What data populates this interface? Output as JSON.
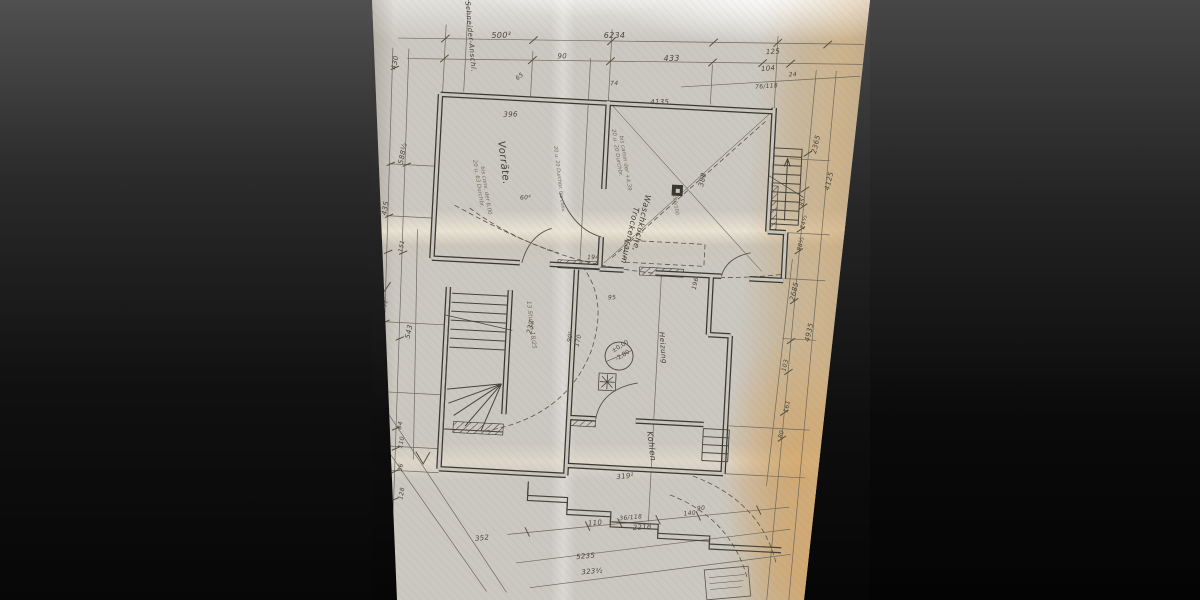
{
  "colors": {
    "paper": "#cbc8c1",
    "ink": "#4a463c",
    "walls": "#3a372f",
    "pencil": "#746e5e",
    "stain_tan": "#c89a5e",
    "stain_orange": "#e4983e",
    "letterbox": "#141414"
  },
  "plan": {
    "drawing_type": "cellar floor plan (aged blueprint photograph)",
    "labels": [
      {
        "id": "dim-500",
        "t": "500³",
        "x": 108,
        "y": 45,
        "r": -4,
        "s": 8
      },
      {
        "id": "dim-6234",
        "t": "6234",
        "x": 220,
        "y": 39,
        "r": -3,
        "s": 8
      },
      {
        "id": "dim-90",
        "t": "90",
        "x": 175,
        "y": 62,
        "r": -4,
        "s": 7
      },
      {
        "id": "dim-433",
        "t": "433",
        "x": 281,
        "y": 59,
        "r": -4,
        "s": 8
      },
      {
        "id": "dim-65",
        "t": "65",
        "x": 136,
        "y": 86,
        "r": -40,
        "s": 6
      },
      {
        "id": "dim-74",
        "t": "74",
        "x": 229,
        "y": 86,
        "r": -4,
        "s": 6
      },
      {
        "id": "dim-125",
        "t": "125",
        "x": 383,
        "y": 47,
        "r": -7,
        "s": 7
      },
      {
        "id": "dim-104",
        "t": "104",
        "x": 379,
        "y": 64,
        "r": -7,
        "s": 7
      },
      {
        "id": "dim-24",
        "t": "24",
        "x": 407,
        "y": 68,
        "r": -7,
        "s": 6
      },
      {
        "id": "dim-76-118",
        "t": "76/118",
        "x": 374,
        "y": 82,
        "r": -7,
        "s": 6
      },
      {
        "id": "dim-430",
        "t": "430",
        "x": 14,
        "y": 82,
        "r": -82,
        "s": 7
      },
      {
        "id": "dim-588",
        "t": "588½",
        "x": 26,
        "y": 176,
        "r": -82,
        "s": 7
      },
      {
        "id": "dim-435",
        "t": "435",
        "x": 12,
        "y": 228,
        "r": -82,
        "s": 7
      },
      {
        "id": "dim-151",
        "t": "151",
        "x": 30,
        "y": 264,
        "r": -82,
        "s": 6
      },
      {
        "id": "dim-367",
        "t": "367½",
        "x": 15,
        "y": 334,
        "r": -82,
        "s": 7
      },
      {
        "id": "dim-543",
        "t": "543",
        "x": 42,
        "y": 350,
        "r": -82,
        "s": 7
      },
      {
        "id": "dim-6435",
        "t": "6435",
        "x": 2,
        "y": 320,
        "r": -82,
        "s": 7
      },
      {
        "id": "dim-138",
        "t": "138",
        "x": 18,
        "y": 404,
        "r": -82,
        "s": 6
      },
      {
        "id": "dim-84",
        "t": "84",
        "x": 38,
        "y": 441,
        "r": -82,
        "s": 6
      },
      {
        "id": "dim-110a",
        "t": "110",
        "x": 40,
        "y": 460,
        "r": -82,
        "s": 6
      },
      {
        "id": "dim-36",
        "t": "36",
        "x": 41,
        "y": 483,
        "r": -82,
        "s": 6
      },
      {
        "id": "dim-128",
        "t": "128",
        "x": 43,
        "y": 511,
        "r": -82,
        "s": 6
      },
      {
        "id": "dim-120",
        "t": "120",
        "x": 22,
        "y": 492,
        "r": -82,
        "s": 6
      },
      {
        "id": "dim-2365",
        "t": "2365",
        "x": 438,
        "y": 144,
        "r": -80,
        "s": 7
      },
      {
        "id": "dim-4125",
        "t": "4125",
        "x": 453,
        "y": 180,
        "r": -80,
        "s": 7
      },
      {
        "id": "dim-85",
        "t": "85",
        "x": 428,
        "y": 197,
        "r": -80,
        "s": 6
      },
      {
        "id": "dim-245",
        "t": "24½",
        "x": 430,
        "y": 220,
        "r": -80,
        "s": 6
      },
      {
        "id": "dim-885",
        "t": "88½",
        "x": 428,
        "y": 242,
        "r": -80,
        "s": 6
      },
      {
        "id": "dim-2685",
        "t": "2685",
        "x": 424,
        "y": 292,
        "r": -80,
        "s": 7
      },
      {
        "id": "dim-4935",
        "t": "4935",
        "x": 441,
        "y": 332,
        "r": -80,
        "s": 7
      },
      {
        "id": "dim-103",
        "t": "103",
        "x": 419,
        "y": 363,
        "r": -80,
        "s": 6
      },
      {
        "id": "dim-161",
        "t": "161",
        "x": 423,
        "y": 404,
        "r": -80,
        "s": 6
      },
      {
        "id": "dim-80",
        "t": "80",
        "x": 419,
        "y": 430,
        "r": -80,
        "s": 6
      },
      {
        "id": "dim-110b",
        "t": "110",
        "x": 230,
        "y": 527,
        "r": -8,
        "s": 7
      },
      {
        "id": "dim-36-118",
        "t": "36/118",
        "x": 261,
        "y": 520,
        "r": -8,
        "s": 6
      },
      {
        "id": "dim-2218",
        "t": "2218",
        "x": 275,
        "y": 529,
        "r": -8,
        "s": 7
      },
      {
        "id": "dim-140",
        "t": "140",
        "x": 325,
        "y": 512,
        "r": -8,
        "s": 6
      },
      {
        "id": "dim-90b",
        "t": "90",
        "x": 338,
        "y": 506,
        "r": -8,
        "s": 6
      },
      {
        "id": "dim-5235",
        "t": "5235",
        "x": 220,
        "y": 561,
        "r": -8,
        "s": 7
      },
      {
        "id": "dim-3235",
        "t": "323½",
        "x": 226,
        "y": 576,
        "r": -8,
        "s": 7
      },
      {
        "id": "dim-352",
        "t": "352",
        "x": 118,
        "y": 548,
        "r": -8,
        "s": 7
      },
      {
        "id": "dim-319",
        "t": "319²",
        "x": 256,
        "y": 479,
        "r": -8,
        "s": 7
      },
      {
        "id": "dim-396",
        "t": "396",
        "x": 124,
        "y": 123,
        "r": -4,
        "s": 7
      },
      {
        "id": "dim-4135",
        "t": "4135",
        "x": 270,
        "y": 103,
        "r": -4,
        "s": 7
      },
      {
        "id": "dim-388",
        "t": "388",
        "x": 327,
        "y": 183,
        "r": -80,
        "s": 7
      },
      {
        "id": "dim-194",
        "t": "194",
        "x": 215,
        "y": 261,
        "r": -4,
        "s": 6
      },
      {
        "id": "dim-196",
        "t": "196",
        "x": 325,
        "y": 286,
        "r": -80,
        "s": 6
      },
      {
        "id": "dim-237",
        "t": "237",
        "x": 163,
        "y": 339,
        "r": -80,
        "s": 7
      },
      {
        "id": "dim-604",
        "t": "60⁴",
        "x": 145,
        "y": 205,
        "r": -6,
        "s": 6
      },
      {
        "id": "dim-905",
        "t": "90⁵",
        "x": 203,
        "y": 345,
        "r": -80,
        "s": 6
      },
      {
        "id": "dim-170",
        "t": "170",
        "x": 211,
        "y": 349,
        "r": -80,
        "s": 6
      },
      {
        "id": "dim-95",
        "t": "95",
        "x": 238,
        "y": 300,
        "r": -4,
        "s": 6
      },
      {
        "id": "stair-note",
        "t": "13 Stufen 18/25",
        "x": 157,
        "y": 306,
        "r": 80,
        "s": 6,
        "c": "pencil"
      },
      {
        "id": "room-vorraete",
        "t": "Vorräte.",
        "x": 120,
        "y": 148,
        "r": 80,
        "s": 10,
        "c": "room"
      },
      {
        "id": "room-waschkueche",
        "t": "Waschküche,",
        "x": 270,
        "y": 193,
        "r": 100,
        "s": 8,
        "c": "room"
      },
      {
        "id": "room-trockenraum",
        "t": "Trockenraum",
        "x": 259,
        "y": 206,
        "r": 100,
        "s": 8,
        "c": "room"
      },
      {
        "id": "room-heizung",
        "t": "Heizung",
        "x": 291,
        "y": 330,
        "r": 82,
        "s": 7,
        "c": "room"
      },
      {
        "id": "room-kohlen",
        "t": "Kohlen",
        "x": 284,
        "y": 430,
        "r": 80,
        "s": 8,
        "c": "room"
      },
      {
        "id": "pipe-label",
        "t": "Schneider-Anschl.",
        "x": 80,
        "y": 10,
        "r": 82,
        "s": 7,
        "c": "room"
      },
      {
        "id": "stamp-line1",
        "t": "±0,00",
        "x": 246,
        "y": 353,
        "r": -35,
        "s": 6,
        "c": "stamp"
      },
      {
        "id": "stamp-line2",
        "t": "-2,80",
        "x": 250,
        "y": 361,
        "r": -35,
        "s": 6,
        "c": "stamp"
      },
      {
        "id": "note-durchbruch-1a",
        "t": "20 u. 63 Durchbr.",
        "x": 96,
        "y": 168,
        "r": 78,
        "s": 5.5,
        "c": "pencil"
      },
      {
        "id": "note-durchbruch-1b",
        "t": "bis conv. der 6,00",
        "x": 104,
        "y": 174,
        "r": 78,
        "s": 5.5,
        "c": "pencil"
      },
      {
        "id": "note-durchbruch-2a",
        "t": "20 u. 20 Durchbr.",
        "x": 233,
        "y": 130,
        "r": 78,
        "s": 5.5,
        "c": "pencil"
      },
      {
        "id": "note-durchbruch-2b",
        "t": "bis camin der +4,39",
        "x": 241,
        "y": 136,
        "r": 78,
        "s": 5.5,
        "c": "pencil"
      },
      {
        "id": "note-100",
        "t": "100/100",
        "x": 297,
        "y": 192,
        "r": 78,
        "s": 5,
        "c": "pencil"
      },
      {
        "id": "note-wall",
        "t": "20 u. 20 Durchbr. bis conv.",
        "x": 176,
        "y": 150,
        "r": 80,
        "s": 5,
        "c": "pencil"
      }
    ]
  }
}
